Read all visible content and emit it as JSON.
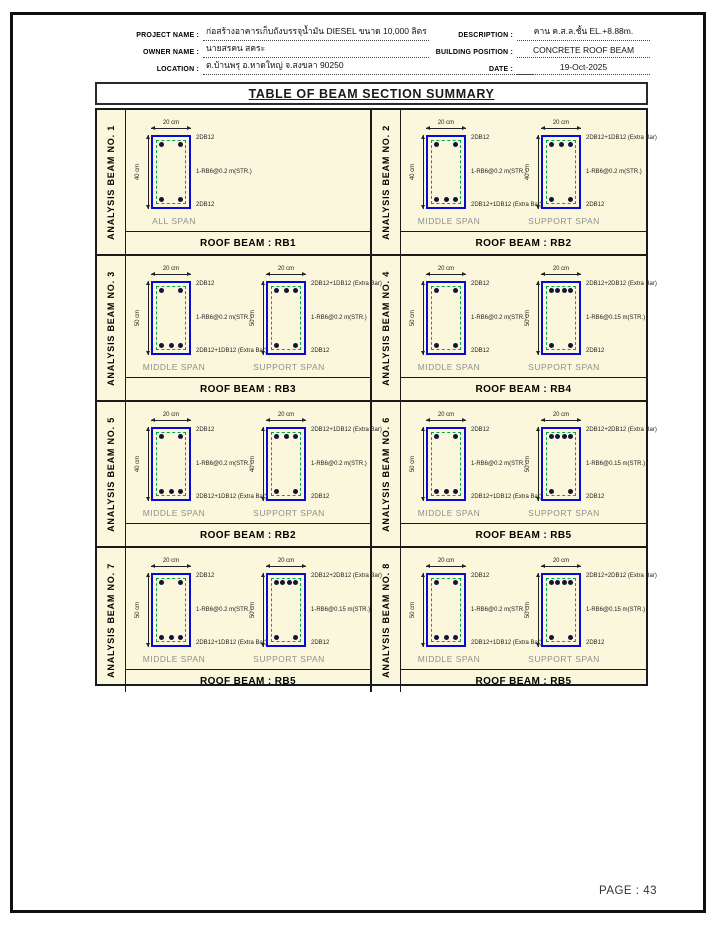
{
  "page": {
    "title": "TABLE OF BEAM SECTION SUMMARY",
    "page_number_label": "PAGE : 43"
  },
  "header": {
    "left_fields": [
      {
        "label": "PROJECT NAME :",
        "value": "ก่อสร้างอาคารเก็บถังบรรจุน้ำมัน DIESEL ขนาด 10,000 ลิตร"
      },
      {
        "label": "OWNER NAME :",
        "value": "นายสรคน สคระ"
      },
      {
        "label": "LOCATION :",
        "value": "ต.บ้านพรุ อ.หาดใหญ่ จ.สงขลา 90250"
      }
    ],
    "right_fields": [
      {
        "label": "DESCRIPTION :",
        "value": "คาน ค.ส.ล.ชั้น EL.+8.88m."
      },
      {
        "label": "BUILDING POSITION :",
        "value": "CONCRETE ROOF BEAM"
      },
      {
        "label": "DATE :",
        "value": "19-Oct-2025"
      }
    ]
  },
  "colors": {
    "cell_background": "#FAF7DC",
    "section_outline_blue": "#0A0AD2",
    "stirrup_green": "#00A651",
    "border_black": "#1A1A1A",
    "span_label_gray": "#8F8F8F"
  },
  "beams": [
    {
      "analysis_label": "ANALYSIS BEAM NO. 1",
      "roof_beam_label": "ROOF BEAM : RB1",
      "sections": [
        {
          "span_label": "ALL SPAN",
          "width_label": "20 cm",
          "height_label": "40 cm",
          "top_bar_label": "2DB12",
          "top_bar_count": 2,
          "stirrup_label": "1-RB6@0.2 m(STR.)",
          "bottom_bar_label": "2DB12",
          "bottom_bar_count": 2
        }
      ]
    },
    {
      "analysis_label": "ANALYSIS BEAM NO. 2",
      "roof_beam_label": "ROOF BEAM : RB2",
      "sections": [
        {
          "span_label": "MIDDLE SPAN",
          "width_label": "20 cm",
          "height_label": "40 cm",
          "top_bar_label": "2DB12",
          "top_bar_count": 2,
          "stirrup_label": "1-RB6@0.2 m(STR.)",
          "bottom_bar_label": "2DB12+1DB12 (Extra Bar)",
          "bottom_bar_count": 3
        },
        {
          "span_label": "SUPPORT SPAN",
          "width_label": "20 cm",
          "height_label": "40 cm",
          "top_bar_label": "2DB12+1DB12 (Extra Bar)",
          "top_bar_count": 3,
          "stirrup_label": "1-RB6@0.2 m(STR.)",
          "bottom_bar_label": "2DB12",
          "bottom_bar_count": 2
        }
      ]
    },
    {
      "analysis_label": "ANALYSIS BEAM NO. 3",
      "roof_beam_label": "ROOF BEAM : RB3",
      "sections": [
        {
          "span_label": "MIDDLE SPAN",
          "width_label": "20 cm",
          "height_label": "50 cm",
          "top_bar_label": "2DB12",
          "top_bar_count": 2,
          "stirrup_label": "1-RB6@0.2 m(STR.)",
          "bottom_bar_label": "2DB12+1DB12 (Extra Bar)",
          "bottom_bar_count": 3
        },
        {
          "span_label": "SUPPORT SPAN",
          "width_label": "20 cm",
          "height_label": "50 cm",
          "top_bar_label": "2DB12+1DB12 (Extra Bar)",
          "top_bar_count": 3,
          "stirrup_label": "1-RB6@0.2 m(STR.)",
          "bottom_bar_label": "2DB12",
          "bottom_bar_count": 2
        }
      ]
    },
    {
      "analysis_label": "ANALYSIS BEAM NO. 4",
      "roof_beam_label": "ROOF BEAM : RB4",
      "sections": [
        {
          "span_label": "MIDDLE SPAN",
          "width_label": "20 cm",
          "height_label": "50 cm",
          "top_bar_label": "2DB12",
          "top_bar_count": 2,
          "stirrup_label": "1-RB6@0.2 m(STR.)",
          "bottom_bar_label": "2DB12",
          "bottom_bar_count": 2
        },
        {
          "span_label": "SUPPORT SPAN",
          "width_label": "20 cm",
          "height_label": "50 cm",
          "top_bar_label": "2DB12+2DB12 (Extra Bar)",
          "top_bar_count": 4,
          "stirrup_label": "1-RB6@0.15 m(STR.)",
          "bottom_bar_label": "2DB12",
          "bottom_bar_count": 2
        }
      ]
    },
    {
      "analysis_label": "ANALYSIS BEAM NO. 5",
      "roof_beam_label": "ROOF BEAM : RB2",
      "sections": [
        {
          "span_label": "MIDDLE SPAN",
          "width_label": "20 cm",
          "height_label": "40 cm",
          "top_bar_label": "2DB12",
          "top_bar_count": 2,
          "stirrup_label": "1-RB6@0.2 m(STR.)",
          "bottom_bar_label": "2DB12+1DB12 (Extra Bar)",
          "bottom_bar_count": 3
        },
        {
          "span_label": "SUPPORT SPAN",
          "width_label": "20 cm",
          "height_label": "40 cm",
          "top_bar_label": "2DB12+1DB12 (Extra Bar)",
          "top_bar_count": 3,
          "stirrup_label": "1-RB6@0.2 m(STR.)",
          "bottom_bar_label": "2DB12",
          "bottom_bar_count": 2
        }
      ]
    },
    {
      "analysis_label": "ANALYSIS BEAM NO. 6",
      "roof_beam_label": "ROOF BEAM : RB5",
      "sections": [
        {
          "span_label": "MIDDLE SPAN",
          "width_label": "20 cm",
          "height_label": "50 cm",
          "top_bar_label": "2DB12",
          "top_bar_count": 2,
          "stirrup_label": "1-RB6@0.2 m(STR.)",
          "bottom_bar_label": "2DB12+1DB12 (Extra Bar)",
          "bottom_bar_count": 3
        },
        {
          "span_label": "SUPPORT SPAN",
          "width_label": "20 cm",
          "height_label": "50 cm",
          "top_bar_label": "2DB12+2DB12 (Extra Bar)",
          "top_bar_count": 4,
          "stirrup_label": "1-RB6@0.15 m(STR.)",
          "bottom_bar_label": "2DB12",
          "bottom_bar_count": 2
        }
      ]
    },
    {
      "analysis_label": "ANALYSIS BEAM NO. 7",
      "roof_beam_label": "ROOF BEAM : RB5",
      "sections": [
        {
          "span_label": "MIDDLE SPAN",
          "width_label": "20 cm",
          "height_label": "50 cm",
          "top_bar_label": "2DB12",
          "top_bar_count": 2,
          "stirrup_label": "1-RB6@0.2 m(STR.)",
          "bottom_bar_label": "2DB12+1DB12 (Extra Bar)",
          "bottom_bar_count": 3
        },
        {
          "span_label": "SUPPORT SPAN",
          "width_label": "20 cm",
          "height_label": "50 cm",
          "top_bar_label": "2DB12+2DB12 (Extra Bar)",
          "top_bar_count": 4,
          "stirrup_label": "1-RB6@0.15 m(STR.)",
          "bottom_bar_label": "2DB12",
          "bottom_bar_count": 2
        }
      ]
    },
    {
      "analysis_label": "ANALYSIS BEAM NO. 8",
      "roof_beam_label": "ROOF BEAM : RB5",
      "sections": [
        {
          "span_label": "MIDDLE SPAN",
          "width_label": "20 cm",
          "height_label": "50 cm",
          "top_bar_label": "2DB12",
          "top_bar_count": 2,
          "stirrup_label": "1-RB6@0.2 m(STR.)",
          "bottom_bar_label": "2DB12+1DB12 (Extra Bar)",
          "bottom_bar_count": 3
        },
        {
          "span_label": "SUPPORT SPAN",
          "width_label": "20 cm",
          "height_label": "50 cm",
          "top_bar_label": "2DB12+2DB12 (Extra Bar)",
          "top_bar_count": 4,
          "stirrup_label": "1-RB6@0.15 m(STR.)",
          "bottom_bar_label": "2DB12",
          "bottom_bar_count": 2
        }
      ]
    }
  ]
}
